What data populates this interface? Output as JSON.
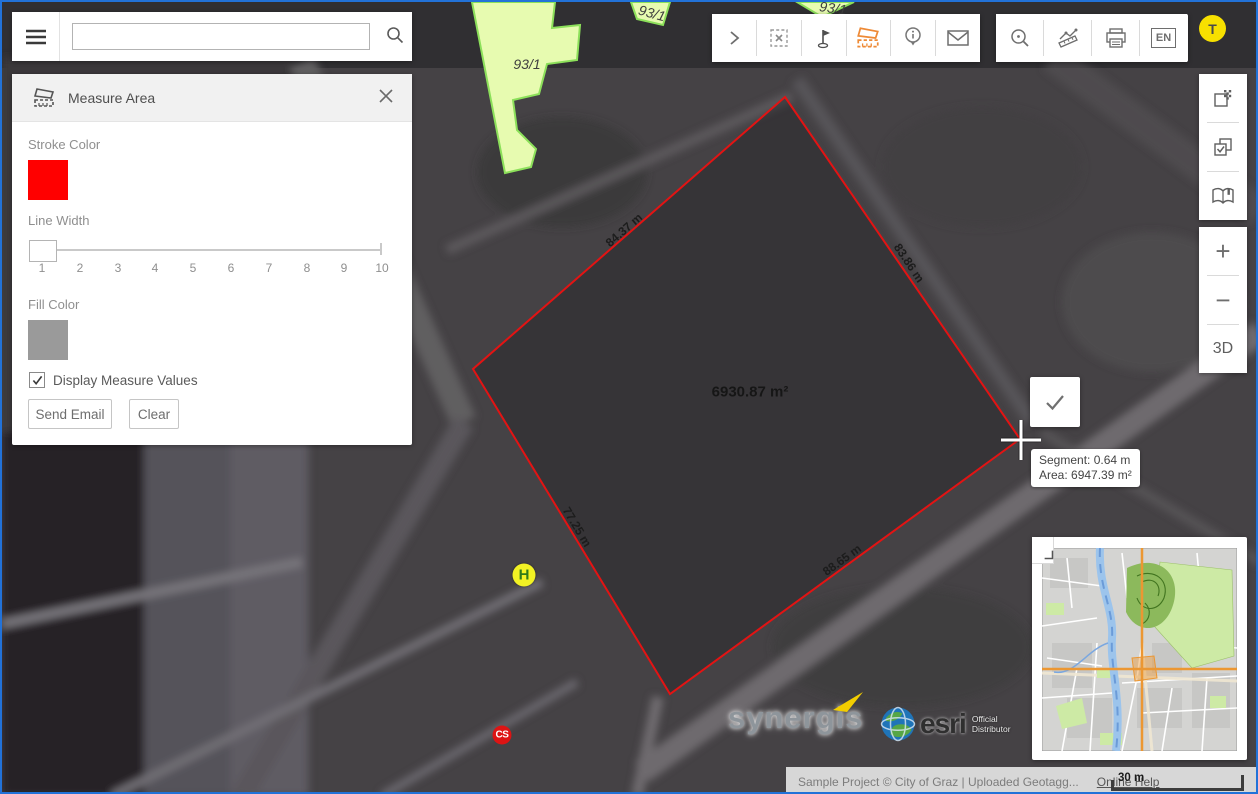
{
  "topbar": {
    "search_placeholder": ""
  },
  "panel": {
    "title": "Measure Area",
    "stroke_color_label": "Stroke Color",
    "stroke_color": "#ff0000",
    "line_width_label": "Line Width",
    "line_width_value": "1",
    "line_width_ticks": [
      "1",
      "2",
      "3",
      "4",
      "5",
      "6",
      "7",
      "8",
      "9",
      "10"
    ],
    "fill_color_label": "Fill Color",
    "fill_color": "#9a9a9a",
    "checkbox_label": "Display Measure Values",
    "checkbox_checked": true,
    "send_email_label": "Send Email",
    "clear_label": "Clear"
  },
  "controls": {
    "zoom_in": "+",
    "zoom_out": "−",
    "three_d": "3D",
    "language": "EN",
    "avatar": "T"
  },
  "measurement": {
    "area_label": "6930.87 m²",
    "segments": [
      {
        "label": "84.37 m"
      },
      {
        "label": "83.86 m"
      },
      {
        "label": "77.25 m"
      },
      {
        "label": "88.65 m"
      }
    ],
    "tooltip": {
      "segment": "Segment: 0.64 m",
      "area": "Area: 6947.39 m²"
    }
  },
  "map": {
    "parcel_labels": [
      "93/1",
      "93/1",
      "93/1"
    ],
    "markers": [
      {
        "label": "H"
      },
      {
        "label": "CS"
      }
    ],
    "stroke_color": "#e31313"
  },
  "logos": {
    "synergis": "synergis",
    "esri": "esri",
    "esri_tag_line1": "Official",
    "esri_tag_line2": "Distributor"
  },
  "statusbar": {
    "attribution": "Sample Project © City of Graz | Uploaded Geotagg...",
    "online_help": "Online Help",
    "scale_label": "30 m"
  },
  "icons": {
    "menu": "hamburger",
    "search": "magnifier",
    "measure-area": "area-ruler",
    "close": "x",
    "expand": "chevron-right",
    "clear-selection": "dashed-box-x",
    "flag-pin": "flag",
    "info": "info-pin",
    "email": "envelope",
    "zoom-select": "magnifier-dot",
    "measure-line": "ruler-polyline",
    "print": "printer",
    "transparency": "checkered-squares",
    "select-layers": "checked-squares",
    "legend": "open-book",
    "confirm": "checkmark",
    "minimap-collapse": "corner-angle"
  }
}
